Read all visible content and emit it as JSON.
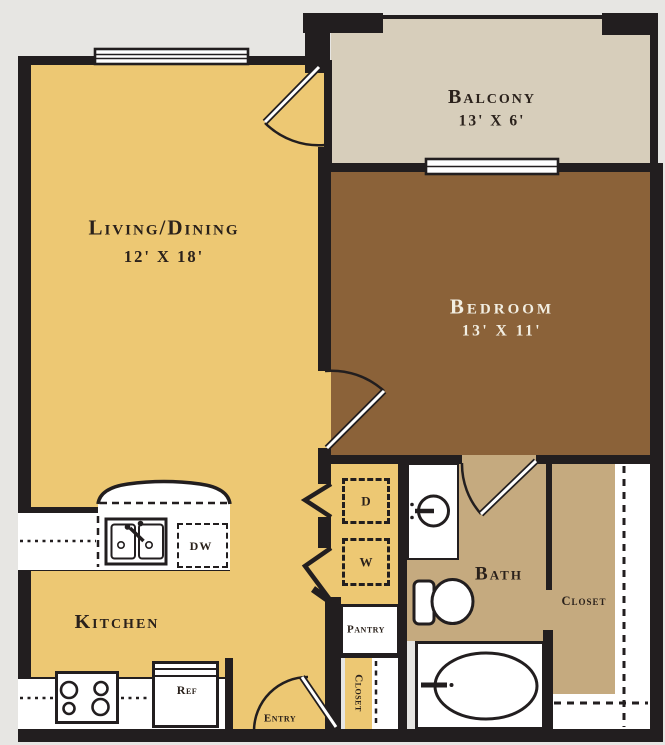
{
  "plan_title": "One-bedroom apartment floor plan",
  "rooms": {
    "living": {
      "label": "Living/Dining",
      "dims": "12' X 18'"
    },
    "balcony": {
      "label": "Balcony",
      "dims": "13' X 6'"
    },
    "bedroom": {
      "label": "Bedroom",
      "dims": "13' X 11'"
    },
    "kitchen": {
      "label": "Kitchen"
    },
    "bath": {
      "label": "Bath"
    },
    "closet": {
      "label": "Closet"
    },
    "entry_closet": {
      "label": "Closet"
    },
    "pantry": {
      "label": "Pantry"
    },
    "entry": {
      "label": "Entry"
    }
  },
  "appliances": {
    "dryer": "D",
    "washer": "W",
    "dishwasher": "DW",
    "refrigerator": "Ref"
  },
  "colors": {
    "background": "#E7E6E3",
    "wall": "#221E1F",
    "living": "#EDC873",
    "balcony": "#D7CEBB",
    "bedroom": "#8B6239",
    "bath": "#C5AA7F",
    "fixture": "#FFFFFF",
    "ink": "#2A211B",
    "ink_light": "#F2EEE2"
  }
}
